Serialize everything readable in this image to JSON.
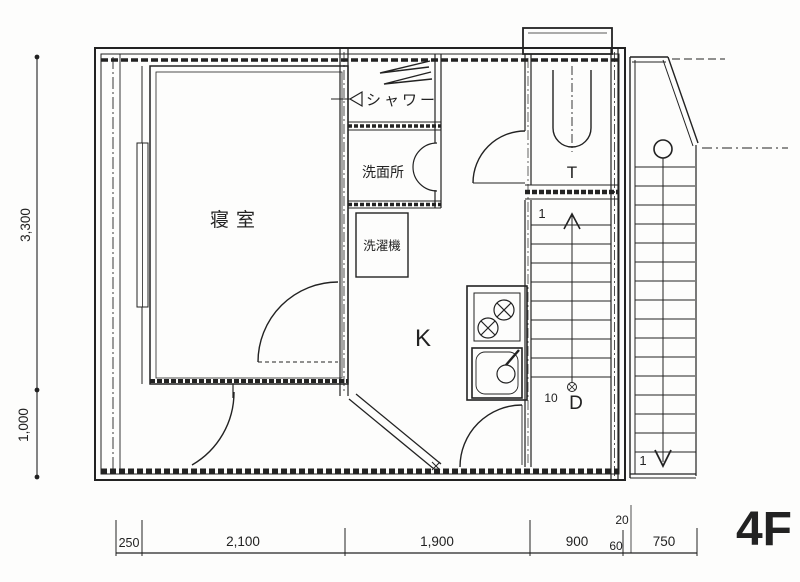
{
  "title": "4F floor plan drawing",
  "floor_label": "4F",
  "rooms": {
    "bedroom": "寝室",
    "shower": "シャワー",
    "washroom": "洗面所",
    "washing_machine": "洗濯機",
    "kitchen": "K",
    "toilet": "T"
  },
  "stairs": {
    "interior_start": "1",
    "interior_end": "10",
    "interior_landing": "D",
    "exterior_start": "1"
  },
  "dimensions": {
    "left": {
      "upper": "3,300",
      "lower": "1,000"
    },
    "bottom": {
      "d1": "250",
      "d2": "2,100",
      "d3": "1,900",
      "d4": "900",
      "d5": "60",
      "small": "20",
      "d6": "750"
    }
  },
  "colors": {
    "ink": "#222222",
    "paper": "#fdfdfc"
  }
}
